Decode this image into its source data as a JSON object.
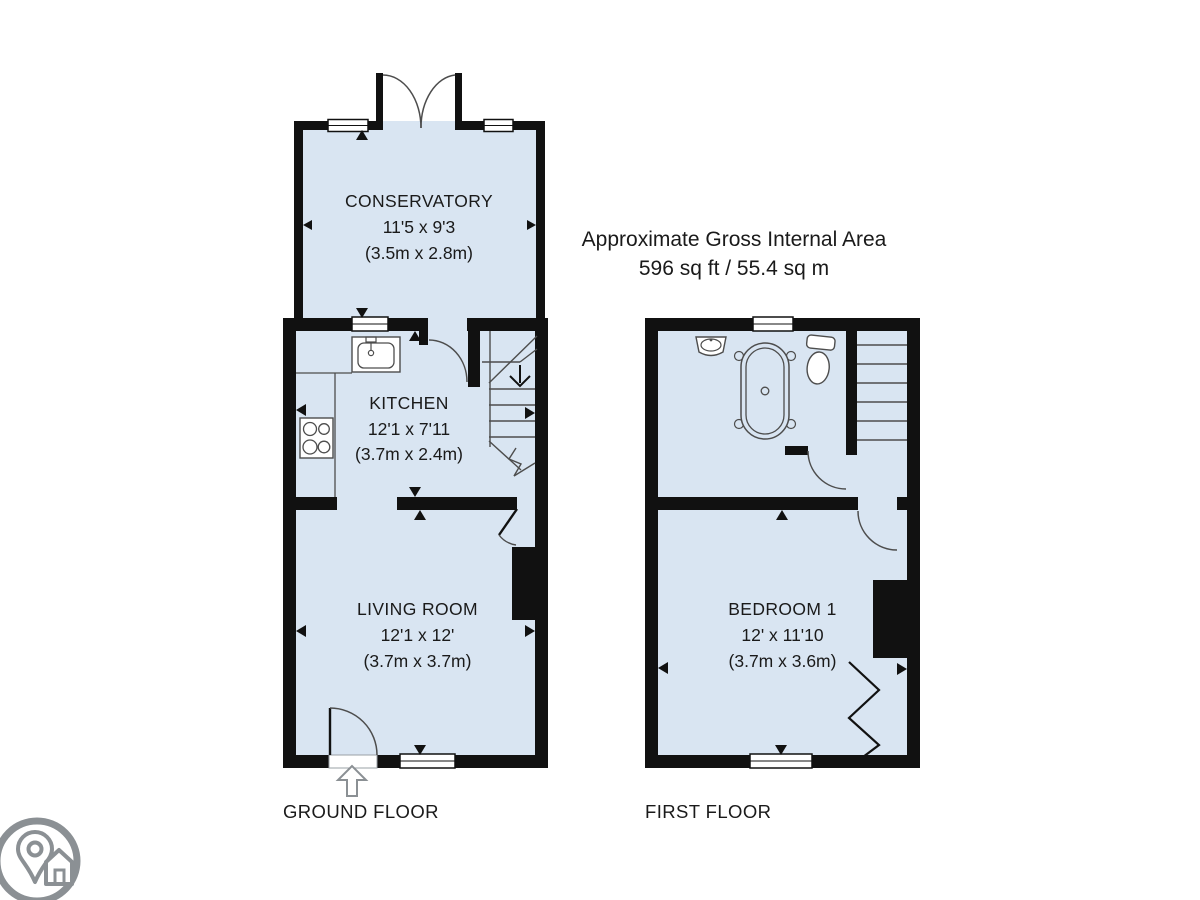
{
  "title_block": {
    "line1": "Approximate Gross Internal Area",
    "line2": "596 sq ft / 55.4 sq m"
  },
  "ground_floor": {
    "label": "GROUND FLOOR",
    "rooms": {
      "conservatory": {
        "name": "CONSERVATORY",
        "dims_imperial": "11'5 x 9'3",
        "dims_metric": "(3.5m x 2.8m)"
      },
      "kitchen": {
        "name": "KITCHEN",
        "dims_imperial": "12'1 x 7'11",
        "dims_metric": "(3.7m x 2.4m)"
      },
      "living_room": {
        "name": "LIVING ROOM",
        "dims_imperial": "12'1 x 12'",
        "dims_metric": "(3.7m x 3.7m)"
      }
    }
  },
  "first_floor": {
    "label": "FIRST FLOOR",
    "rooms": {
      "bedroom_1": {
        "name": "BEDROOM 1",
        "dims_imperial": "12' x 11'10",
        "dims_metric": "(3.7m x 3.6m)"
      }
    }
  },
  "colors": {
    "room_fill": "#d9e5f2",
    "wall": "#111111",
    "fixture_line": "#4d4d4d",
    "logo_gray": "#8b9094",
    "text": "#1a1a1a"
  },
  "icons": {
    "logo": "map-pin-house-logo-icon"
  }
}
